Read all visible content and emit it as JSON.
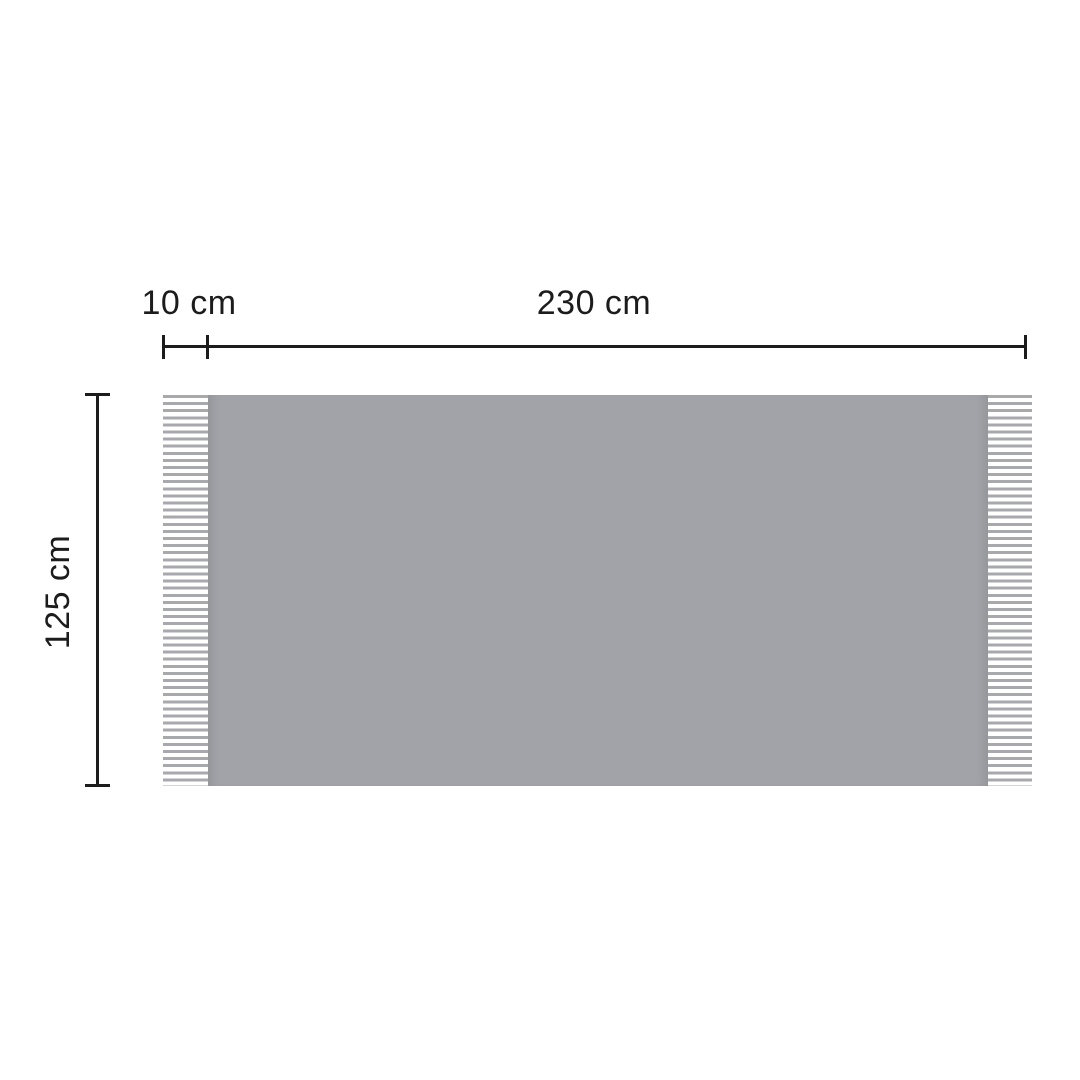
{
  "diagram": {
    "labels": {
      "fringe_width": "10 cm",
      "width": "230 cm",
      "height": "125 cm"
    }
  },
  "colors": {
    "background": "#ffffff",
    "blanket-body": "#a1a3a8",
    "fringe-stripe": "#a8a9ac",
    "dimension-line": "#1c1c1c"
  }
}
